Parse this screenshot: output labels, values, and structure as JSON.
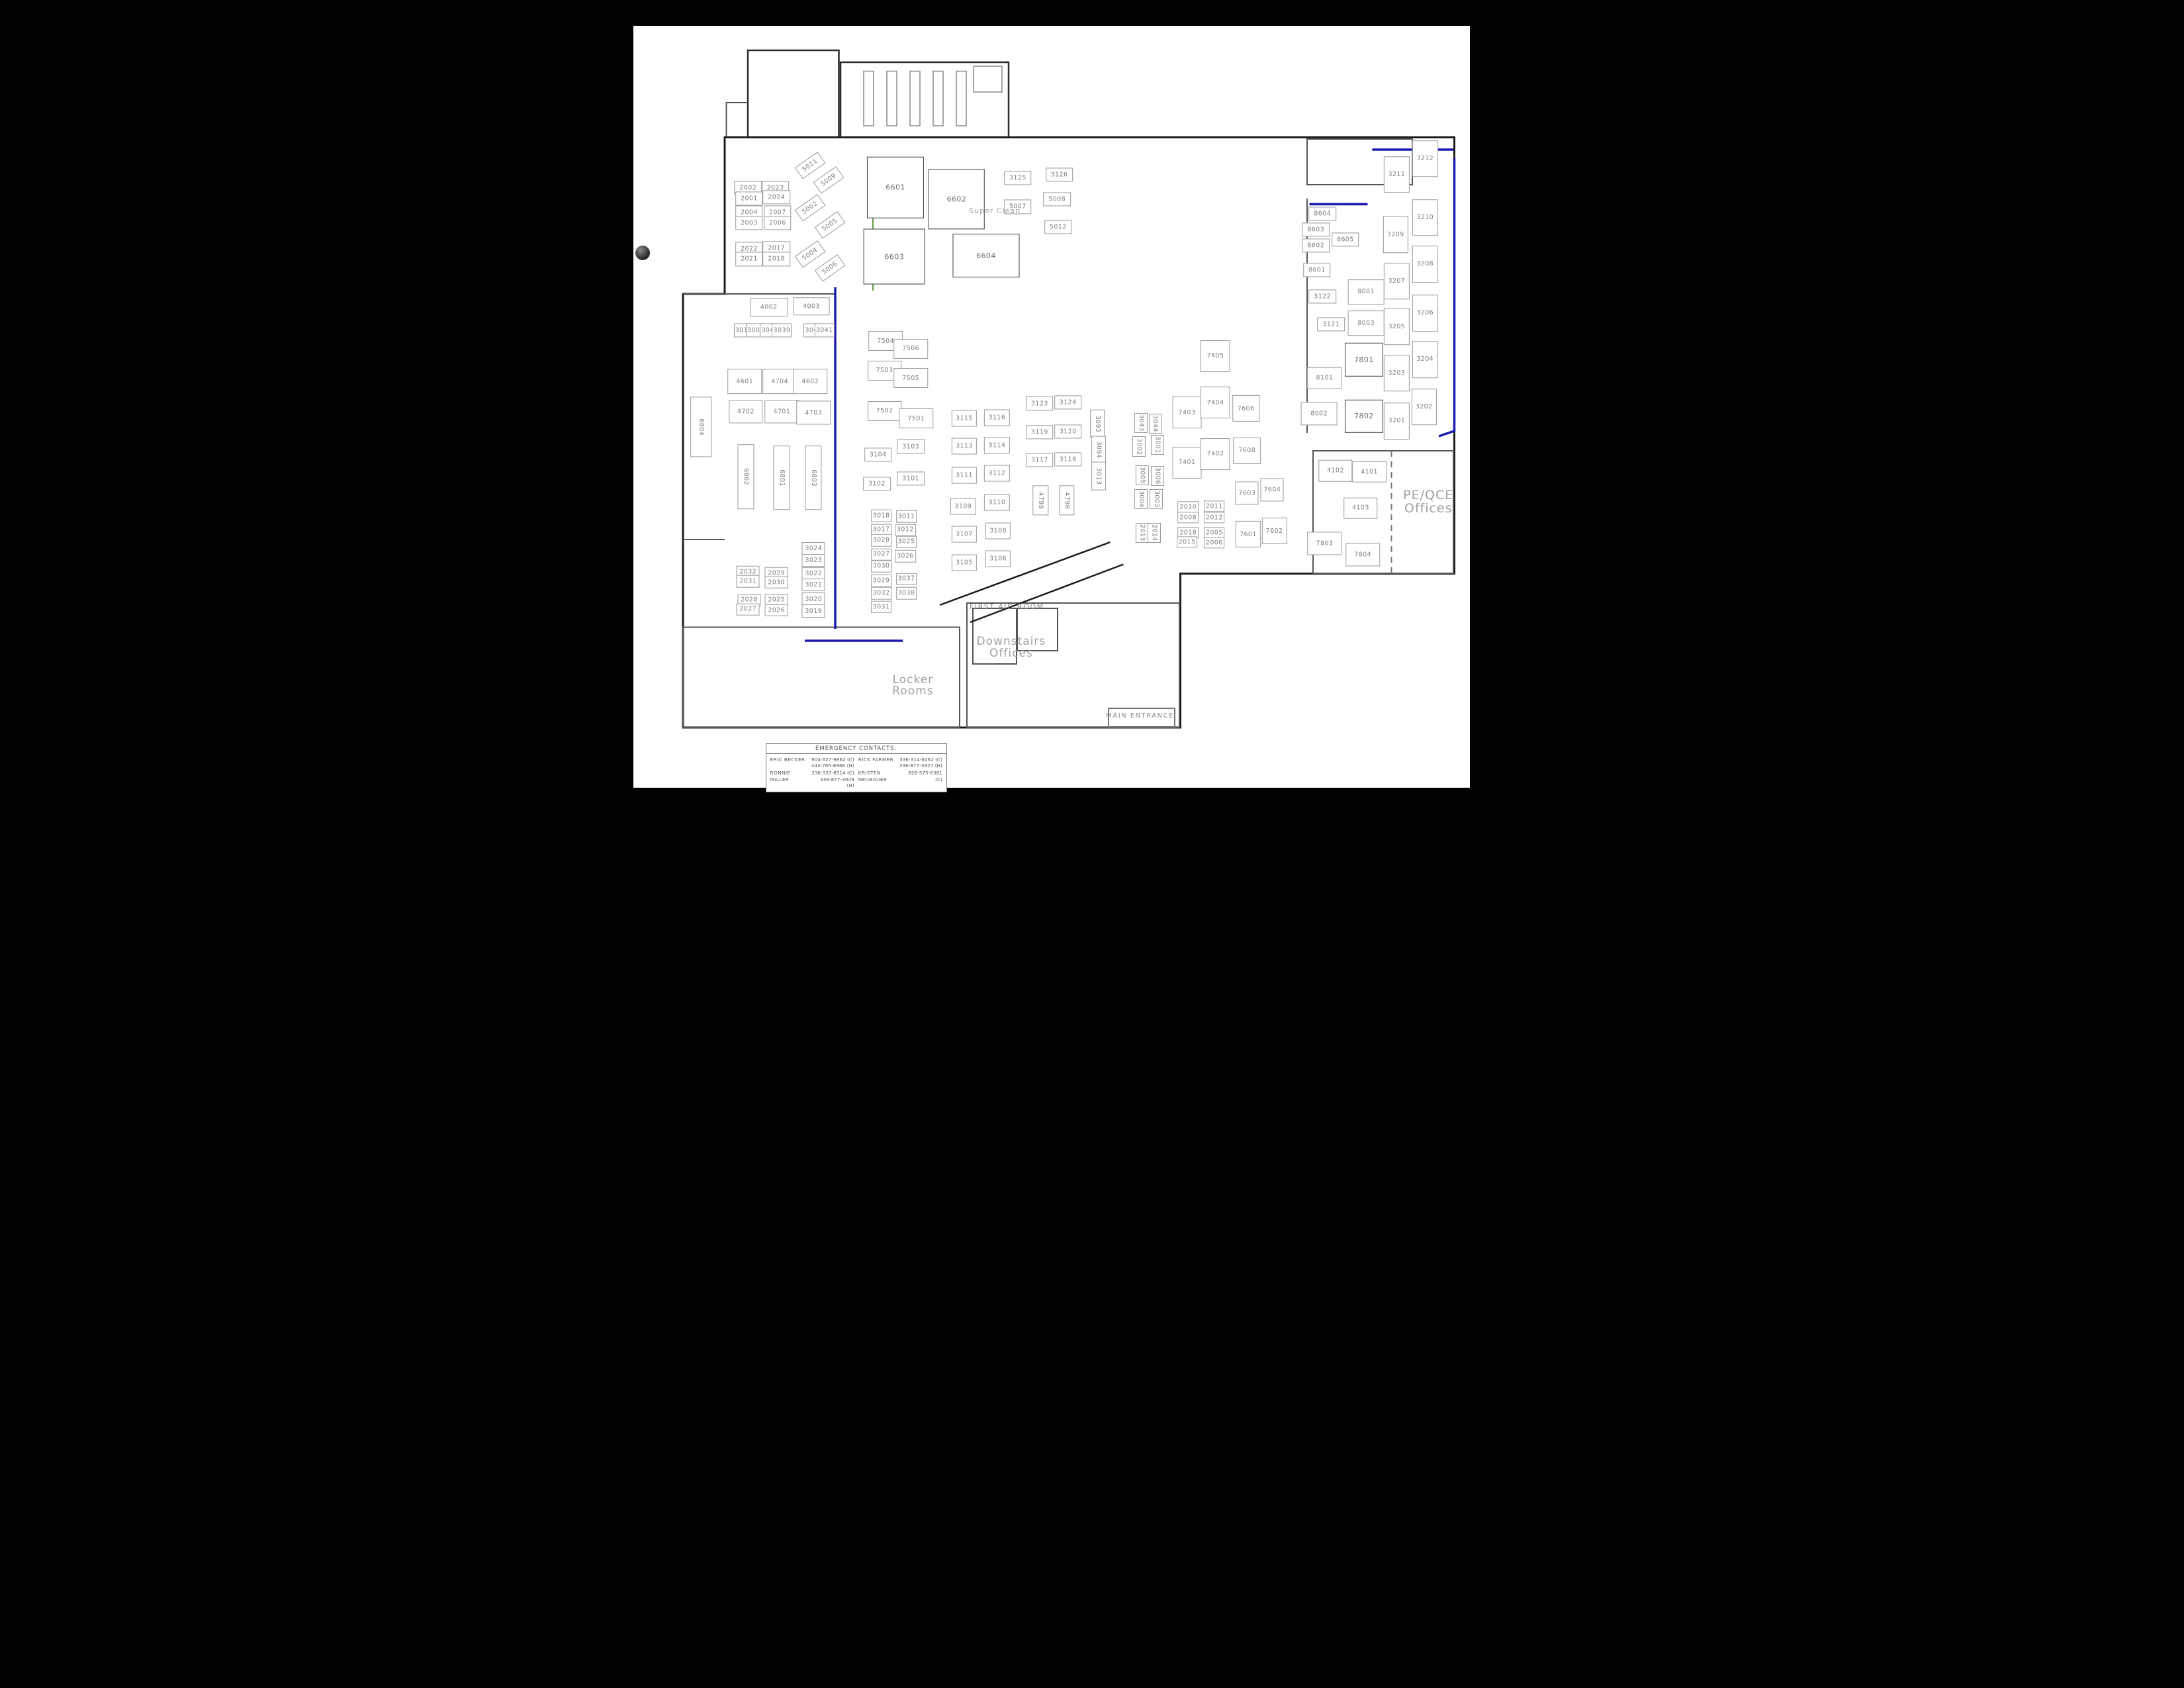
{
  "page": {
    "background": "#000000",
    "paper": "#ffffff",
    "wall_color": "#1c1c1c",
    "accent_blue": "#1b1bb0",
    "accent_green": "#6a9a4a"
  },
  "area_labels": [
    {
      "text": "Super Clean",
      "x": 41.1,
      "y": 25.0,
      "size": 11,
      "caps": false
    },
    {
      "text": "PE/QCE\nOffices",
      "x": 80.8,
      "y": 59.5,
      "size": 19,
      "caps": false
    },
    {
      "text": "FIRST AID ROOM",
      "x": 42.2,
      "y": 71.9,
      "size": 11,
      "caps": true
    },
    {
      "text": "Downstairs\nOffices",
      "x": 42.6,
      "y": 76.8,
      "size": 17,
      "caps": false
    },
    {
      "text": "Locker\nRooms",
      "x": 33.6,
      "y": 81.3,
      "size": 17,
      "caps": false
    },
    {
      "text": "MAIN ENTRANCE",
      "x": 54.4,
      "y": 84.9,
      "size": 10,
      "caps": true
    }
  ],
  "emergency_contacts": {
    "title": "EMERGENCY CONTACTS:",
    "entries": [
      {
        "name": "ERIC BECKER",
        "phones": "904-527-9862 (C)\n443-765-8966 (H)"
      },
      {
        "name": "RICK FARMER",
        "phones": "336-314-6062 (C)\n336-877-3927 (H)"
      },
      {
        "name": "RONNIE MILLER",
        "phones": "336-337-8514 (C)\n336-877-3049 (H)"
      },
      {
        "name": "KRISTEN NEUBAUER",
        "phones": "828-575-6361 (C)"
      }
    ]
  },
  "rooms": [
    {
      "n": "2002",
      "x": 18.5,
      "y": 22.3
    },
    {
      "n": "2001",
      "x": 18.6,
      "y": 23.5
    },
    {
      "n": "2023",
      "x": 21.0,
      "y": 22.3
    },
    {
      "n": "2024",
      "x": 21.1,
      "y": 23.4
    },
    {
      "n": "2004",
      "x": 18.6,
      "y": 25.2
    },
    {
      "n": "2003",
      "x": 18.6,
      "y": 26.4
    },
    {
      "n": "2007",
      "x": 21.2,
      "y": 25.2
    },
    {
      "n": "2006",
      "x": 21.2,
      "y": 26.4
    },
    {
      "n": "2022",
      "x": 18.6,
      "y": 29.5
    },
    {
      "n": "2021",
      "x": 18.6,
      "y": 30.7
    },
    {
      "n": "2017",
      "x": 21.1,
      "y": 29.4
    },
    {
      "n": "2018",
      "x": 21.1,
      "y": 30.7
    },
    {
      "n": "5011",
      "x": 24.2,
      "y": 19.6,
      "r": -35
    },
    {
      "n": "5009",
      "x": 25.9,
      "y": 21.3,
      "r": -35
    },
    {
      "n": "5002",
      "x": 24.2,
      "y": 24.6,
      "r": -35
    },
    {
      "n": "5005",
      "x": 26.0,
      "y": 26.7,
      "r": -35
    },
    {
      "n": "5004",
      "x": 24.2,
      "y": 30.1,
      "r": -35
    },
    {
      "n": "5006",
      "x": 26.0,
      "y": 31.8,
      "r": -35
    },
    {
      "n": "6601",
      "x": 32.0,
      "y": 22.2,
      "w": 5.1,
      "h": 7.1,
      "big": true
    },
    {
      "n": "6602",
      "x": 37.6,
      "y": 23.6,
      "w": 5.0,
      "h": 7.0,
      "big": true
    },
    {
      "n": "6603",
      "x": 31.9,
      "y": 30.4,
      "w": 5.5,
      "h": 6.5,
      "big": true
    },
    {
      "n": "6604",
      "x": 40.3,
      "y": 30.3,
      "w": 6.0,
      "h": 5.0,
      "big": true
    },
    {
      "n": "3125",
      "x": 43.2,
      "y": 21.1
    },
    {
      "n": "5007",
      "x": 43.2,
      "y": 24.5
    },
    {
      "n": "3126",
      "x": 47.0,
      "y": 20.7
    },
    {
      "n": "5008",
      "x": 46.8,
      "y": 23.6
    },
    {
      "n": "5012",
      "x": 46.9,
      "y": 26.9
    },
    {
      "n": "8604",
      "x": 71.1,
      "y": 25.3
    },
    {
      "n": "8603",
      "x": 70.5,
      "y": 27.2
    },
    {
      "n": "8602",
      "x": 70.5,
      "y": 29.1
    },
    {
      "n": "8605",
      "x": 73.2,
      "y": 28.4
    },
    {
      "n": "8601",
      "x": 70.6,
      "y": 32.0
    },
    {
      "n": "8001",
      "x": 75.1,
      "y": 34.6,
      "w": 3.2,
      "h": 2.8
    },
    {
      "n": "8003",
      "x": 75.1,
      "y": 38.3,
      "w": 3.2,
      "h": 2.8
    },
    {
      "n": "8002",
      "x": 70.8,
      "y": 49.0,
      "w": 3.2,
      "h": 2.6
    },
    {
      "n": "8101",
      "x": 71.3,
      "y": 44.8,
      "w": 3.0,
      "h": 2.4
    },
    {
      "n": "3122",
      "x": 71.1,
      "y": 35.1
    },
    {
      "n": "3121",
      "x": 71.9,
      "y": 38.4
    },
    {
      "n": "7801",
      "x": 74.9,
      "y": 42.6,
      "w": 3.4,
      "h": 3.8,
      "big": true
    },
    {
      "n": "7802",
      "x": 74.9,
      "y": 49.3,
      "w": 3.4,
      "h": 3.8,
      "big": true
    },
    {
      "n": "3211",
      "x": 77.9,
      "y": 20.7,
      "w": 2.2,
      "h": 4.2
    },
    {
      "n": "3212",
      "x": 80.5,
      "y": 18.8,
      "w": 2.2,
      "h": 4.2
    },
    {
      "n": "3209",
      "x": 77.8,
      "y": 27.8,
      "w": 2.2,
      "h": 4.2
    },
    {
      "n": "3210",
      "x": 80.5,
      "y": 25.8,
      "w": 2.2,
      "h": 4.2
    },
    {
      "n": "3207",
      "x": 77.9,
      "y": 33.3,
      "w": 2.2,
      "h": 4.2
    },
    {
      "n": "3208",
      "x": 80.5,
      "y": 31.3,
      "w": 2.2,
      "h": 4.2
    },
    {
      "n": "3205",
      "x": 77.9,
      "y": 38.7,
      "w": 2.2,
      "h": 4.2
    },
    {
      "n": "3206",
      "x": 80.5,
      "y": 37.1,
      "w": 2.2,
      "h": 4.2
    },
    {
      "n": "3203",
      "x": 77.9,
      "y": 44.2,
      "w": 2.2,
      "h": 4.2
    },
    {
      "n": "3204",
      "x": 80.5,
      "y": 42.6,
      "w": 2.2,
      "h": 4.2
    },
    {
      "n": "3201",
      "x": 77.9,
      "y": 49.9,
      "w": 2.2,
      "h": 4.2
    },
    {
      "n": "3202",
      "x": 80.4,
      "y": 48.2,
      "w": 2.2,
      "h": 4.2
    },
    {
      "n": "4002",
      "x": 20.4,
      "y": 36.4,
      "w": 3.4,
      "h": 2.0
    },
    {
      "n": "4003",
      "x": 24.3,
      "y": 36.3,
      "w": 3.2,
      "h": 2.0
    },
    {
      "n": "3010",
      "x": 18.1,
      "y": 39.1,
      "w": 1.7
    },
    {
      "n": "3009",
      "x": 19.2,
      "y": 39.1,
      "w": 1.7
    },
    {
      "n": "3040",
      "x": 20.5,
      "y": 39.1,
      "w": 1.7
    },
    {
      "n": "3039",
      "x": 21.6,
      "y": 39.1,
      "w": 1.7
    },
    {
      "n": "3042",
      "x": 24.5,
      "y": 39.1,
      "w": 1.7
    },
    {
      "n": "3041",
      "x": 25.5,
      "y": 39.1,
      "w": 1.7
    },
    {
      "n": "4601",
      "x": 18.2,
      "y": 45.2,
      "w": 3.0,
      "h": 2.8
    },
    {
      "n": "4704",
      "x": 21.4,
      "y": 45.2,
      "w": 3.0,
      "h": 2.8
    },
    {
      "n": "4602",
      "x": 24.2,
      "y": 45.2,
      "w": 3.0,
      "h": 2.8
    },
    {
      "n": "4702",
      "x": 18.3,
      "y": 48.8,
      "w": 3.0,
      "h": 2.6
    },
    {
      "n": "4701",
      "x": 21.6,
      "y": 48.8,
      "w": 3.0,
      "h": 2.6
    },
    {
      "n": "4703",
      "x": 24.5,
      "y": 48.9,
      "w": 3.0,
      "h": 2.6
    },
    {
      "n": "6802",
      "x": 18.3,
      "y": 56.5,
      "v": true,
      "w": 1.4,
      "h": 7.5
    },
    {
      "n": "6801",
      "x": 21.6,
      "y": 56.6,
      "v": true,
      "w": 1.4,
      "h": 7.5
    },
    {
      "n": "6803",
      "x": 24.5,
      "y": 56.6,
      "v": true,
      "w": 1.4,
      "h": 7.5
    },
    {
      "n": "6804",
      "x": 14.2,
      "y": 50.6,
      "v": true,
      "w": 1.8,
      "h": 7.0
    },
    {
      "n": "7504",
      "x": 31.1,
      "y": 40.4,
      "w": 3.0,
      "h": 2.2
    },
    {
      "n": "7506",
      "x": 33.4,
      "y": 41.3,
      "w": 3.0,
      "h": 2.2
    },
    {
      "n": "7503",
      "x": 31.0,
      "y": 43.9,
      "w": 3.0,
      "h": 2.2
    },
    {
      "n": "7505",
      "x": 33.4,
      "y": 44.8,
      "w": 3.0,
      "h": 2.2
    },
    {
      "n": "7502",
      "x": 31.0,
      "y": 48.7,
      "w": 3.0,
      "h": 2.2
    },
    {
      "n": "7501",
      "x": 33.9,
      "y": 49.6,
      "w": 3.0,
      "h": 2.2
    },
    {
      "n": "3104",
      "x": 30.4,
      "y": 53.9
    },
    {
      "n": "3103",
      "x": 33.4,
      "y": 52.9
    },
    {
      "n": "3102",
      "x": 30.3,
      "y": 57.3
    },
    {
      "n": "3101",
      "x": 33.4,
      "y": 56.7
    },
    {
      "n": "3018",
      "x": 30.7,
      "y": 61.1,
      "w": 1.8,
      "h": 1.3
    },
    {
      "n": "3017",
      "x": 30.7,
      "y": 62.8,
      "w": 1.8,
      "h": 1.3
    },
    {
      "n": "3011",
      "x": 33.0,
      "y": 61.2,
      "w": 1.8,
      "h": 1.3
    },
    {
      "n": "3012",
      "x": 32.9,
      "y": 62.8,
      "w": 1.8,
      "h": 1.3
    },
    {
      "n": "3028",
      "x": 30.7,
      "y": 64.0,
      "w": 1.8,
      "h": 1.3
    },
    {
      "n": "3027",
      "x": 30.7,
      "y": 65.7,
      "w": 1.8,
      "h": 1.3
    },
    {
      "n": "3025",
      "x": 33.0,
      "y": 64.2,
      "w": 1.8,
      "h": 1.3
    },
    {
      "n": "3026",
      "x": 32.9,
      "y": 65.9,
      "w": 1.8,
      "h": 1.3
    },
    {
      "n": "3030",
      "x": 30.7,
      "y": 67.1,
      "w": 1.8,
      "h": 1.3
    },
    {
      "n": "3029",
      "x": 30.7,
      "y": 68.8,
      "w": 1.8,
      "h": 1.3
    },
    {
      "n": "3037",
      "x": 33.0,
      "y": 68.6,
      "w": 1.8,
      "h": 1.3
    },
    {
      "n": "3038",
      "x": 33.0,
      "y": 70.3,
      "w": 1.8,
      "h": 1.3
    },
    {
      "n": "3032",
      "x": 30.7,
      "y": 70.3,
      "w": 1.8,
      "h": 1.3
    },
    {
      "n": "3031",
      "x": 30.7,
      "y": 71.9,
      "w": 1.8,
      "h": 1.3
    },
    {
      "n": "3115",
      "x": 38.3,
      "y": 49.6,
      "w": 2.2,
      "h": 1.8
    },
    {
      "n": "3116",
      "x": 41.3,
      "y": 49.5,
      "w": 2.2,
      "h": 1.8
    },
    {
      "n": "3113",
      "x": 38.3,
      "y": 52.9,
      "w": 2.2,
      "h": 1.8
    },
    {
      "n": "3114",
      "x": 41.3,
      "y": 52.8,
      "w": 2.2,
      "h": 1.8
    },
    {
      "n": "3111",
      "x": 38.3,
      "y": 56.3,
      "w": 2.2,
      "h": 1.8
    },
    {
      "n": "3112",
      "x": 41.3,
      "y": 56.1,
      "w": 2.2,
      "h": 1.8
    },
    {
      "n": "3109",
      "x": 38.2,
      "y": 60.0,
      "w": 2.2,
      "h": 1.8
    },
    {
      "n": "3110",
      "x": 41.3,
      "y": 59.5,
      "w": 2.2,
      "h": 1.8
    },
    {
      "n": "3107",
      "x": 38.3,
      "y": 63.3,
      "w": 2.2,
      "h": 1.8
    },
    {
      "n": "3108",
      "x": 41.4,
      "y": 62.9,
      "w": 2.2,
      "h": 1.8
    },
    {
      "n": "3105",
      "x": 38.3,
      "y": 66.7,
      "w": 2.2,
      "h": 1.8
    },
    {
      "n": "3106",
      "x": 41.4,
      "y": 66.2,
      "w": 2.2,
      "h": 1.8
    },
    {
      "n": "3123",
      "x": 45.2,
      "y": 47.8
    },
    {
      "n": "3124",
      "x": 47.8,
      "y": 47.7
    },
    {
      "n": "3119",
      "x": 45.2,
      "y": 51.2
    },
    {
      "n": "3120",
      "x": 47.8,
      "y": 51.1
    },
    {
      "n": "3117",
      "x": 45.2,
      "y": 54.5
    },
    {
      "n": "3118",
      "x": 47.8,
      "y": 54.4
    },
    {
      "n": "3093",
      "x": 50.5,
      "y": 50.2,
      "v": true,
      "w": 1.2,
      "h": 3.2
    },
    {
      "n": "3094",
      "x": 50.6,
      "y": 53.3,
      "v": true,
      "w": 1.2,
      "h": 3.2
    },
    {
      "n": "3013",
      "x": 50.6,
      "y": 56.4,
      "v": true,
      "w": 1.2,
      "h": 3.2
    },
    {
      "n": "4799",
      "x": 45.3,
      "y": 59.3,
      "v": true,
      "w": 1.3,
      "h": 3.4
    },
    {
      "n": "4798",
      "x": 47.7,
      "y": 59.3,
      "v": true,
      "w": 1.3,
      "h": 3.4
    },
    {
      "n": "7405",
      "x": 61.3,
      "y": 42.2,
      "w": 2.6,
      "h": 3.6
    },
    {
      "n": "7403",
      "x": 58.7,
      "y": 48.9,
      "w": 2.6,
      "h": 3.6
    },
    {
      "n": "7404",
      "x": 61.3,
      "y": 47.7,
      "w": 2.6,
      "h": 3.6
    },
    {
      "n": "7401",
      "x": 58.7,
      "y": 54.8,
      "w": 2.6,
      "h": 3.6
    },
    {
      "n": "7402",
      "x": 61.3,
      "y": 53.8,
      "w": 2.6,
      "h": 3.6
    },
    {
      "n": "7606",
      "x": 64.1,
      "y": 48.4,
      "w": 2.4,
      "h": 3.0
    },
    {
      "n": "7608",
      "x": 64.2,
      "y": 53.4,
      "w": 2.4,
      "h": 3.0
    },
    {
      "n": "7603",
      "x": 64.2,
      "y": 58.4,
      "w": 2.0,
      "h": 2.6
    },
    {
      "n": "7604",
      "x": 66.5,
      "y": 58.0,
      "w": 2.0,
      "h": 2.6
    },
    {
      "n": "7601",
      "x": 64.3,
      "y": 63.3,
      "w": 2.2,
      "h": 3.0
    },
    {
      "n": "7602",
      "x": 66.7,
      "y": 62.9,
      "w": 2.2,
      "h": 3.0
    },
    {
      "n": "2011",
      "x": 61.2,
      "y": 60.0,
      "w": 1.8,
      "h": 1.2
    },
    {
      "n": "2012",
      "x": 61.2,
      "y": 61.3,
      "w": 1.8,
      "h": 1.2
    },
    {
      "n": "2005",
      "x": 61.2,
      "y": 63.1,
      "w": 1.8,
      "h": 1.2
    },
    {
      "n": "2006",
      "x": 61.2,
      "y": 64.3,
      "w": 1.8,
      "h": 1.2
    },
    {
      "n": "2010",
      "x": 58.8,
      "y": 60.1,
      "w": 1.8,
      "h": 1.2
    },
    {
      "n": "2008",
      "x": 58.8,
      "y": 61.3,
      "w": 1.8,
      "h": 1.2
    },
    {
      "n": "2018",
      "x": 58.8,
      "y": 63.1,
      "w": 1.8,
      "h": 1.2
    },
    {
      "n": "2015",
      "x": 58.7,
      "y": 64.2,
      "w": 1.8,
      "h": 1.2
    },
    {
      "n": "3043",
      "x": 54.5,
      "y": 50.1,
      "v": true,
      "w": 1.1,
      "h": 2.2
    },
    {
      "n": "3044",
      "x": 55.8,
      "y": 50.2,
      "v": true,
      "w": 1.1,
      "h": 2.2
    },
    {
      "n": "3002",
      "x": 54.3,
      "y": 52.9,
      "v": true,
      "w": 1.1,
      "h": 2.2
    },
    {
      "n": "3001",
      "x": 56.0,
      "y": 52.7,
      "v": true,
      "w": 1.1,
      "h": 2.2
    },
    {
      "n": "3005",
      "x": 54.6,
      "y": 56.3,
      "v": true,
      "w": 1.1,
      "h": 2.2
    },
    {
      "n": "3006",
      "x": 56.0,
      "y": 56.4,
      "v": true,
      "w": 1.1,
      "h": 2.2
    },
    {
      "n": "3004",
      "x": 54.5,
      "y": 59.1,
      "v": true,
      "w": 1.1,
      "h": 2.2
    },
    {
      "n": "3003",
      "x": 55.9,
      "y": 59.1,
      "v": true,
      "w": 1.1,
      "h": 2.2
    },
    {
      "n": "2013",
      "x": 54.6,
      "y": 63.1,
      "v": true,
      "w": 1.1,
      "h": 2.2
    },
    {
      "n": "2014",
      "x": 55.7,
      "y": 63.1,
      "v": true,
      "w": 1.1,
      "h": 2.2
    },
    {
      "n": "4102",
      "x": 72.3,
      "y": 55.8,
      "w": 3.0,
      "h": 2.4
    },
    {
      "n": "4101",
      "x": 75.4,
      "y": 55.9,
      "w": 3.0,
      "h": 2.4
    },
    {
      "n": "4103",
      "x": 74.6,
      "y": 60.2,
      "w": 3.0,
      "h": 2.4
    },
    {
      "n": "7803",
      "x": 71.3,
      "y": 64.4,
      "w": 3.0,
      "h": 2.6
    },
    {
      "n": "7804",
      "x": 74.8,
      "y": 65.7,
      "w": 3.0,
      "h": 2.6
    },
    {
      "n": "2032",
      "x": 18.5,
      "y": 67.8,
      "w": 2.0,
      "h": 1.3
    },
    {
      "n": "2031",
      "x": 18.5,
      "y": 68.9,
      "w": 2.0,
      "h": 1.3
    },
    {
      "n": "2029",
      "x": 21.1,
      "y": 67.9,
      "w": 2.0,
      "h": 1.3
    },
    {
      "n": "2030",
      "x": 21.1,
      "y": 69.0,
      "w": 2.0,
      "h": 1.3
    },
    {
      "n": "2028",
      "x": 18.6,
      "y": 71.1,
      "w": 2.0,
      "h": 1.3
    },
    {
      "n": "2027",
      "x": 18.5,
      "y": 72.2,
      "w": 2.0,
      "h": 1.3
    },
    {
      "n": "2025",
      "x": 21.1,
      "y": 71.1,
      "w": 2.0,
      "h": 1.3
    },
    {
      "n": "2026",
      "x": 21.1,
      "y": 72.3,
      "w": 2.0,
      "h": 1.3
    },
    {
      "n": "3024",
      "x": 24.5,
      "y": 65.0,
      "w": 2.0,
      "h": 1.4
    },
    {
      "n": "3023",
      "x": 24.5,
      "y": 66.4,
      "w": 2.0,
      "h": 1.4
    },
    {
      "n": "3022",
      "x": 24.5,
      "y": 68.0,
      "w": 2.0,
      "h": 1.4
    },
    {
      "n": "3021",
      "x": 24.5,
      "y": 69.3,
      "w": 2.0,
      "h": 1.4
    },
    {
      "n": "3020",
      "x": 24.5,
      "y": 71.0,
      "w": 2.0,
      "h": 1.4
    },
    {
      "n": "3019",
      "x": 24.5,
      "y": 72.4,
      "w": 2.0,
      "h": 1.4
    }
  ]
}
